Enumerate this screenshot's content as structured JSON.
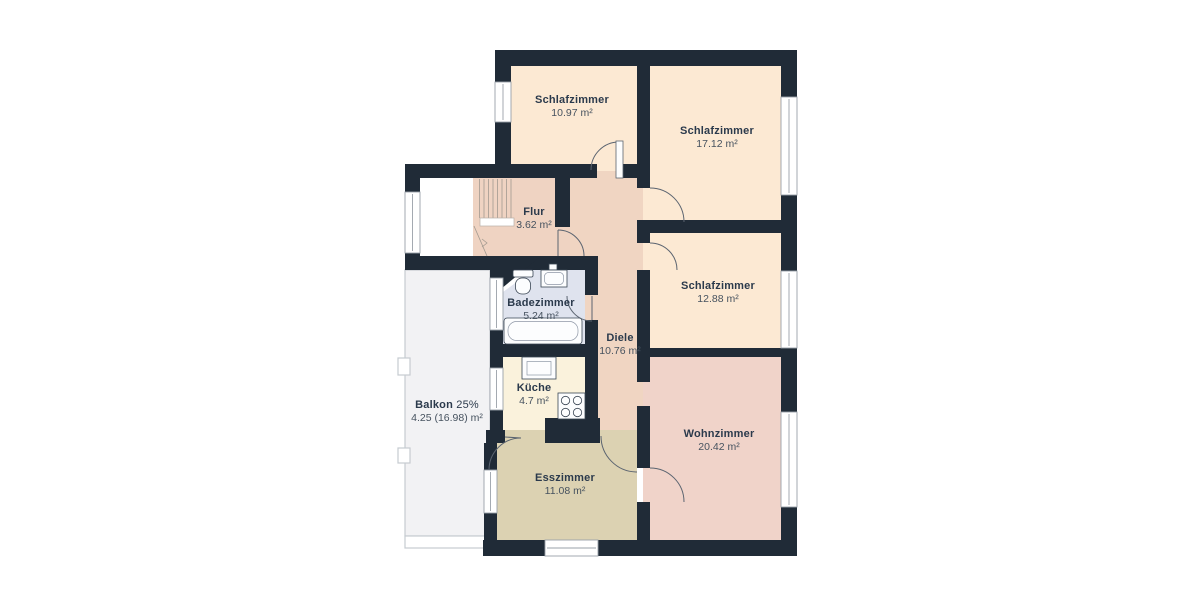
{
  "colors": {
    "background": "#ffffff",
    "wall": "#202b37",
    "bedroom_floor": "#fce9d3",
    "hallway_floor": "#f0d5c2",
    "entry_floor": "#efd3c2",
    "living_floor": "#f0d3c9",
    "dining_floor": "#dcd2b2",
    "bathroom_floor": "#dfe3ee",
    "kitchen_floor": "#faf2dc",
    "balcony_floor": "#f2f2f4",
    "stairwell_floor": "#ffffff",
    "window": "#ffffff",
    "window_frame": "#9aa1a9",
    "door_arc": "#5b6470",
    "door_leaf": "#fdfdfd",
    "fixture_fill": "#fcfdfe",
    "fixture_stroke": "#3a4654",
    "room_name_text": "#2b3a4c",
    "room_area_text": "#46525f"
  },
  "rooms": [
    {
      "id": "schlafzimmer-1",
      "name": "Schlafzimmer",
      "area": "10.97 m²"
    },
    {
      "id": "schlafzimmer-2",
      "name": "Schlafzimmer",
      "area": "17.12 m²"
    },
    {
      "id": "flur",
      "name": "Flur",
      "area": "3.62 m²"
    },
    {
      "id": "schlafzimmer-3",
      "name": "Schlafzimmer",
      "area": "12.88 m²"
    },
    {
      "id": "badezimmer",
      "name": "Badezimmer",
      "area": "5.24 m²"
    },
    {
      "id": "diele",
      "name": "Diele",
      "area": "10.76 m²"
    },
    {
      "id": "kueche",
      "name": "Küche",
      "area": "4.7 m²"
    },
    {
      "id": "balkon",
      "name": "Balkon",
      "name_suffix": "25%",
      "area": "4.25 (16.98) m²"
    },
    {
      "id": "wohnzimmer",
      "name": "Wohnzimmer",
      "area": "20.42 m²"
    },
    {
      "id": "esszimmer",
      "name": "Esszimmer",
      "area": "11.08 m²"
    }
  ]
}
